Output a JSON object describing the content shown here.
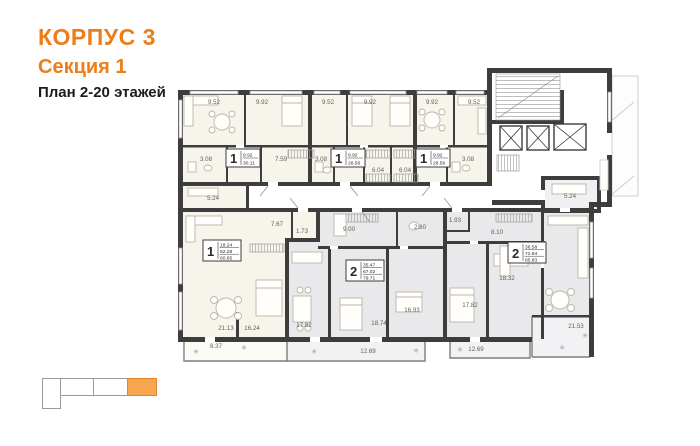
{
  "header": {
    "building": "КОРПУС 3",
    "section": "Секция 1",
    "floors_plan": "План 2-20 этажей"
  },
  "colors": {
    "accent_orange": "#ee7d17",
    "minimap_highlight": "#f6a74e",
    "wall": "#3d3d3d",
    "apartment_cream": "#f7f4ec",
    "apartment_gray": "#e9e9ec"
  },
  "icons": {
    "plant": "✳"
  },
  "plan": {
    "room_labels": [
      "9.52",
      "9.92",
      "9.52",
      "9.92",
      "9.92",
      "9.52",
      "3.08",
      "7.59",
      "3.08",
      "6.04",
      "6.04",
      "3.08",
      "5.24",
      "7.67",
      "1.73",
      "9.00",
      "2.80",
      "1.93",
      "8.10",
      "5.24",
      "21.13",
      "16.24",
      "8.37",
      "17.82",
      "18.74",
      "16.93",
      "12.69",
      "17.82",
      "18.32",
      "12.69",
      "21.53"
    ],
    "apartments": [
      {
        "type": "1",
        "living_area": "9.92",
        "total_area": "30.11"
      },
      {
        "type": "1",
        "living_area": "9.92",
        "total_area": "28.56"
      },
      {
        "type": "1",
        "living_area": "9.92",
        "total_area": "28.56"
      },
      {
        "type": "1",
        "living_area": "18.24",
        "area": "52.28",
        "total_area": "60.65"
      },
      {
        "type": "2",
        "living_area": "35.47",
        "area": "67.02",
        "total_area": "79.71"
      },
      {
        "type": "2",
        "living_area": "36.58",
        "area": "72.94",
        "total_area": "85.83"
      }
    ]
  }
}
